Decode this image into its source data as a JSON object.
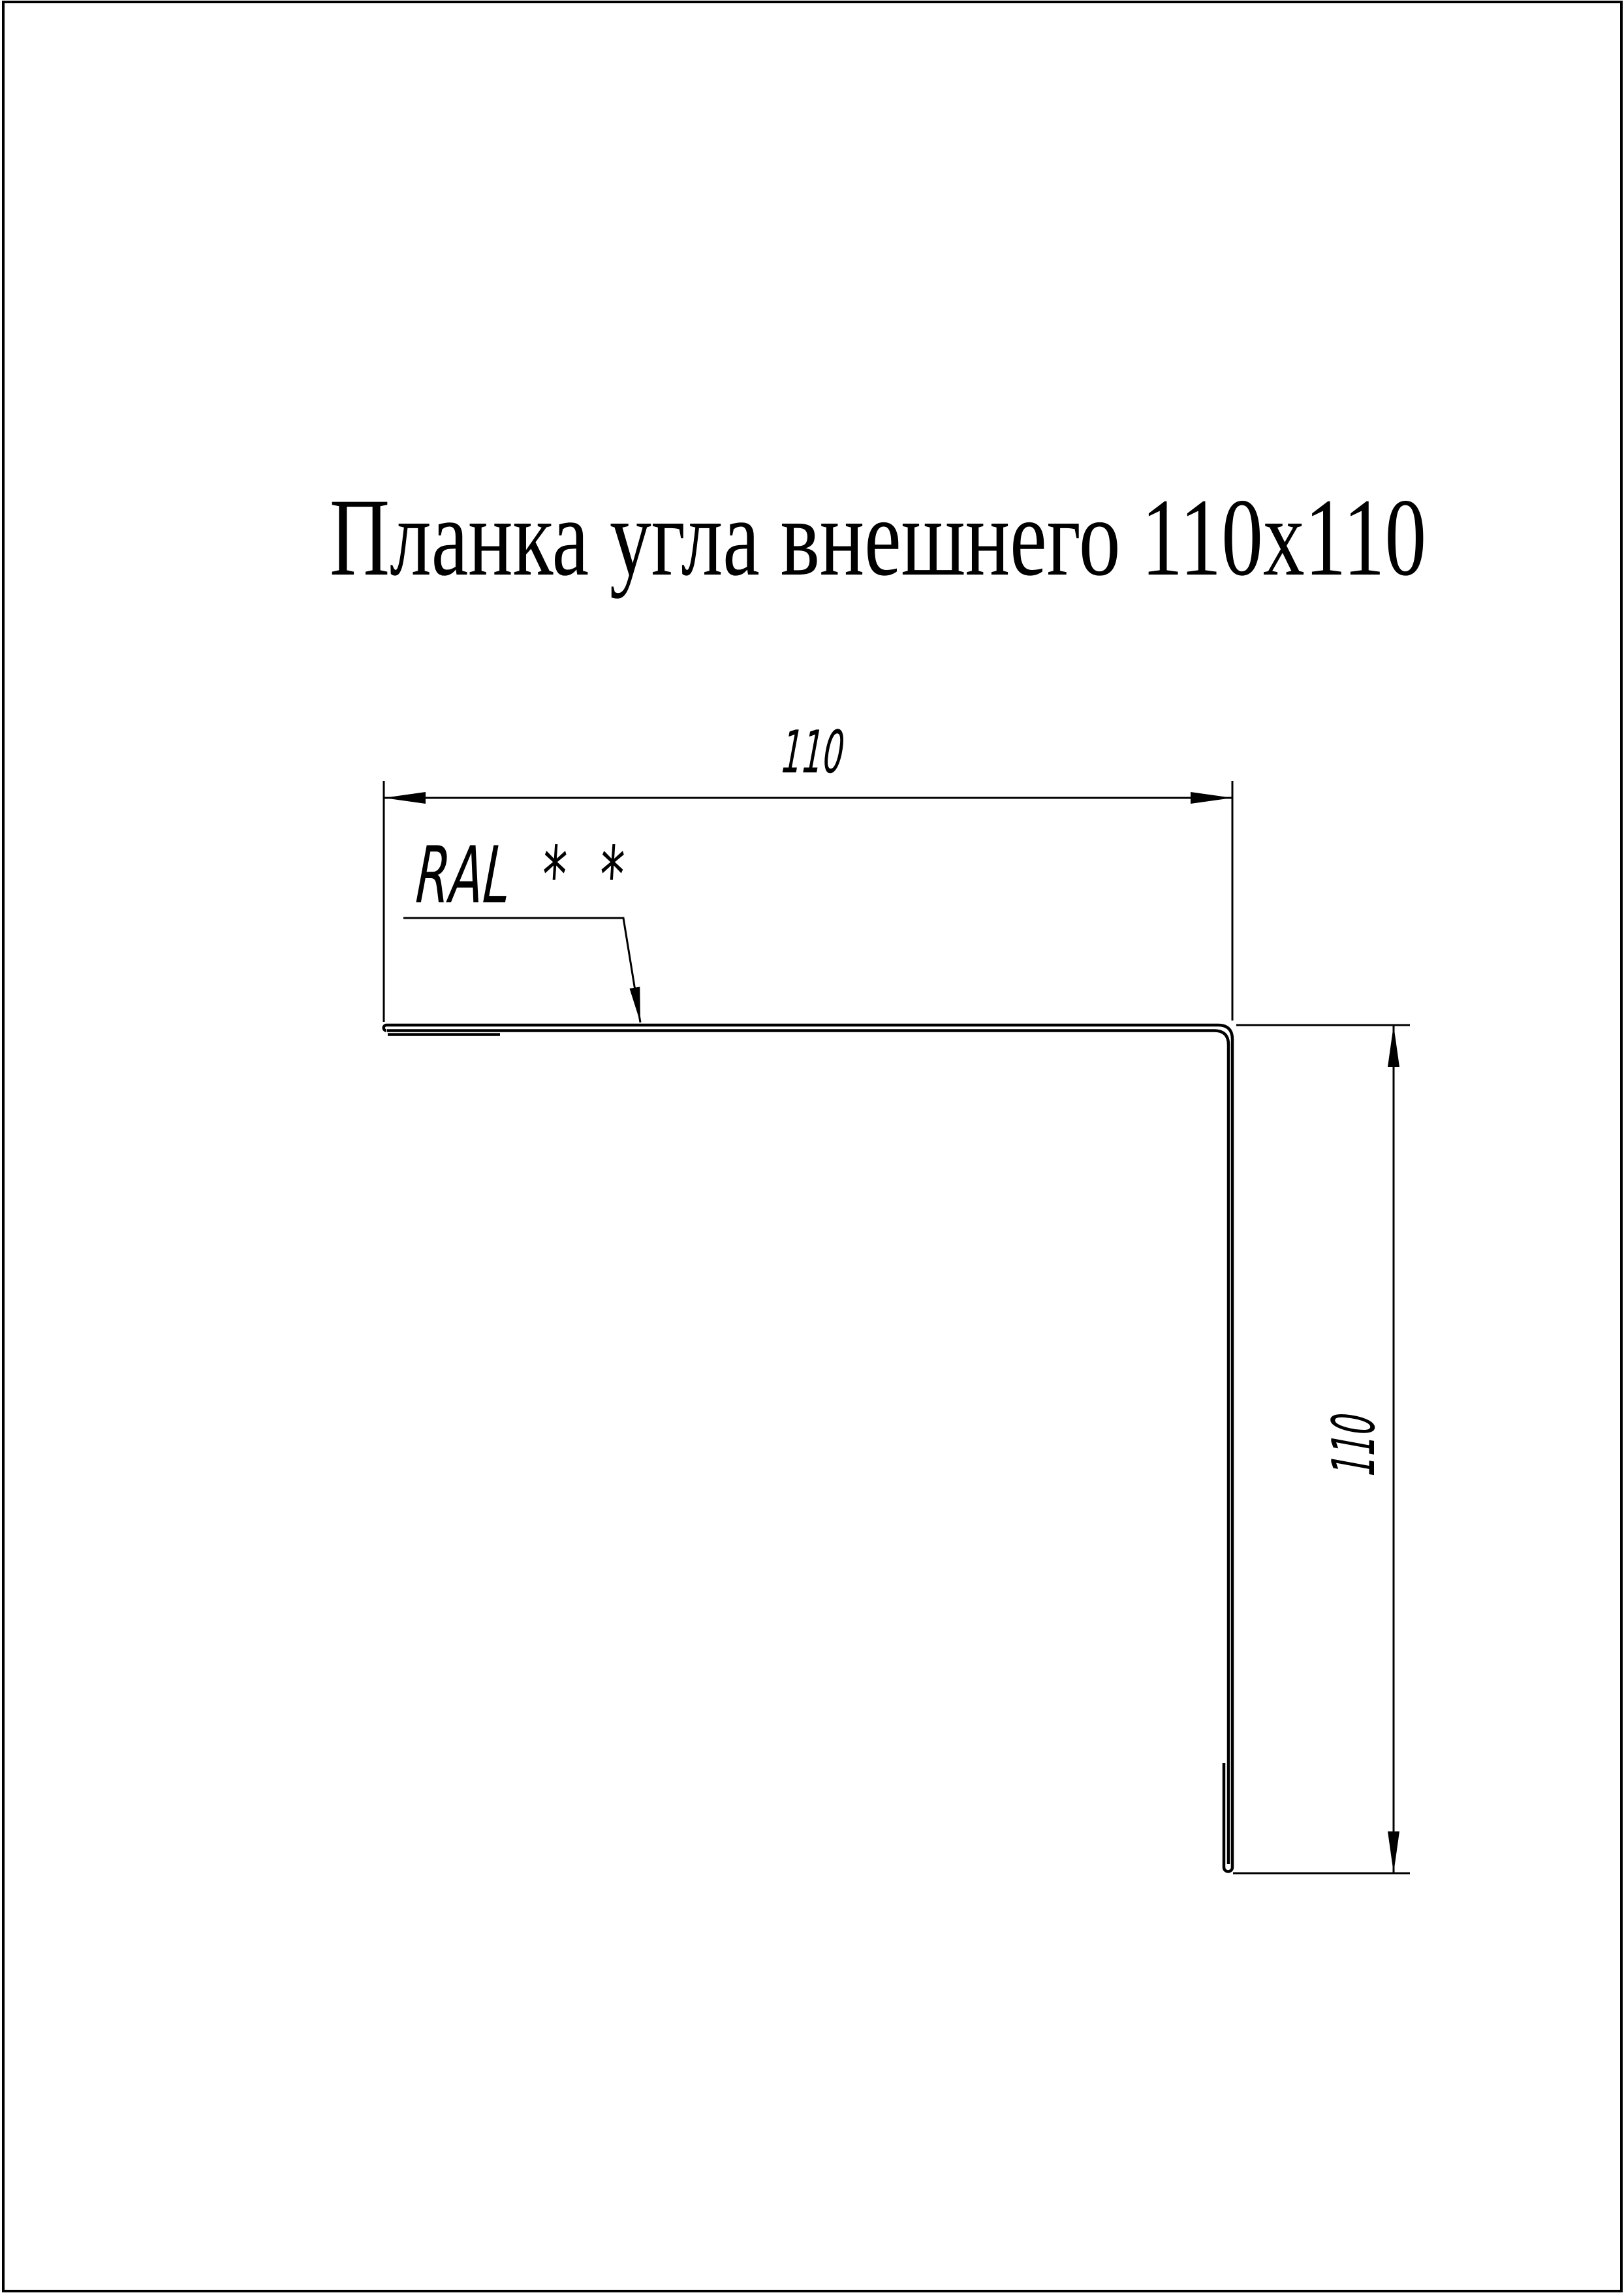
{
  "page": {
    "background": "#ffffff",
    "line_color": "#000000"
  },
  "title": {
    "text": "Планка угла внешнего 110x110"
  },
  "dimensions": {
    "top": {
      "value": "110"
    },
    "side": {
      "value": "110"
    }
  },
  "leader": {
    "label": "RAL",
    "stars": "* *"
  }
}
